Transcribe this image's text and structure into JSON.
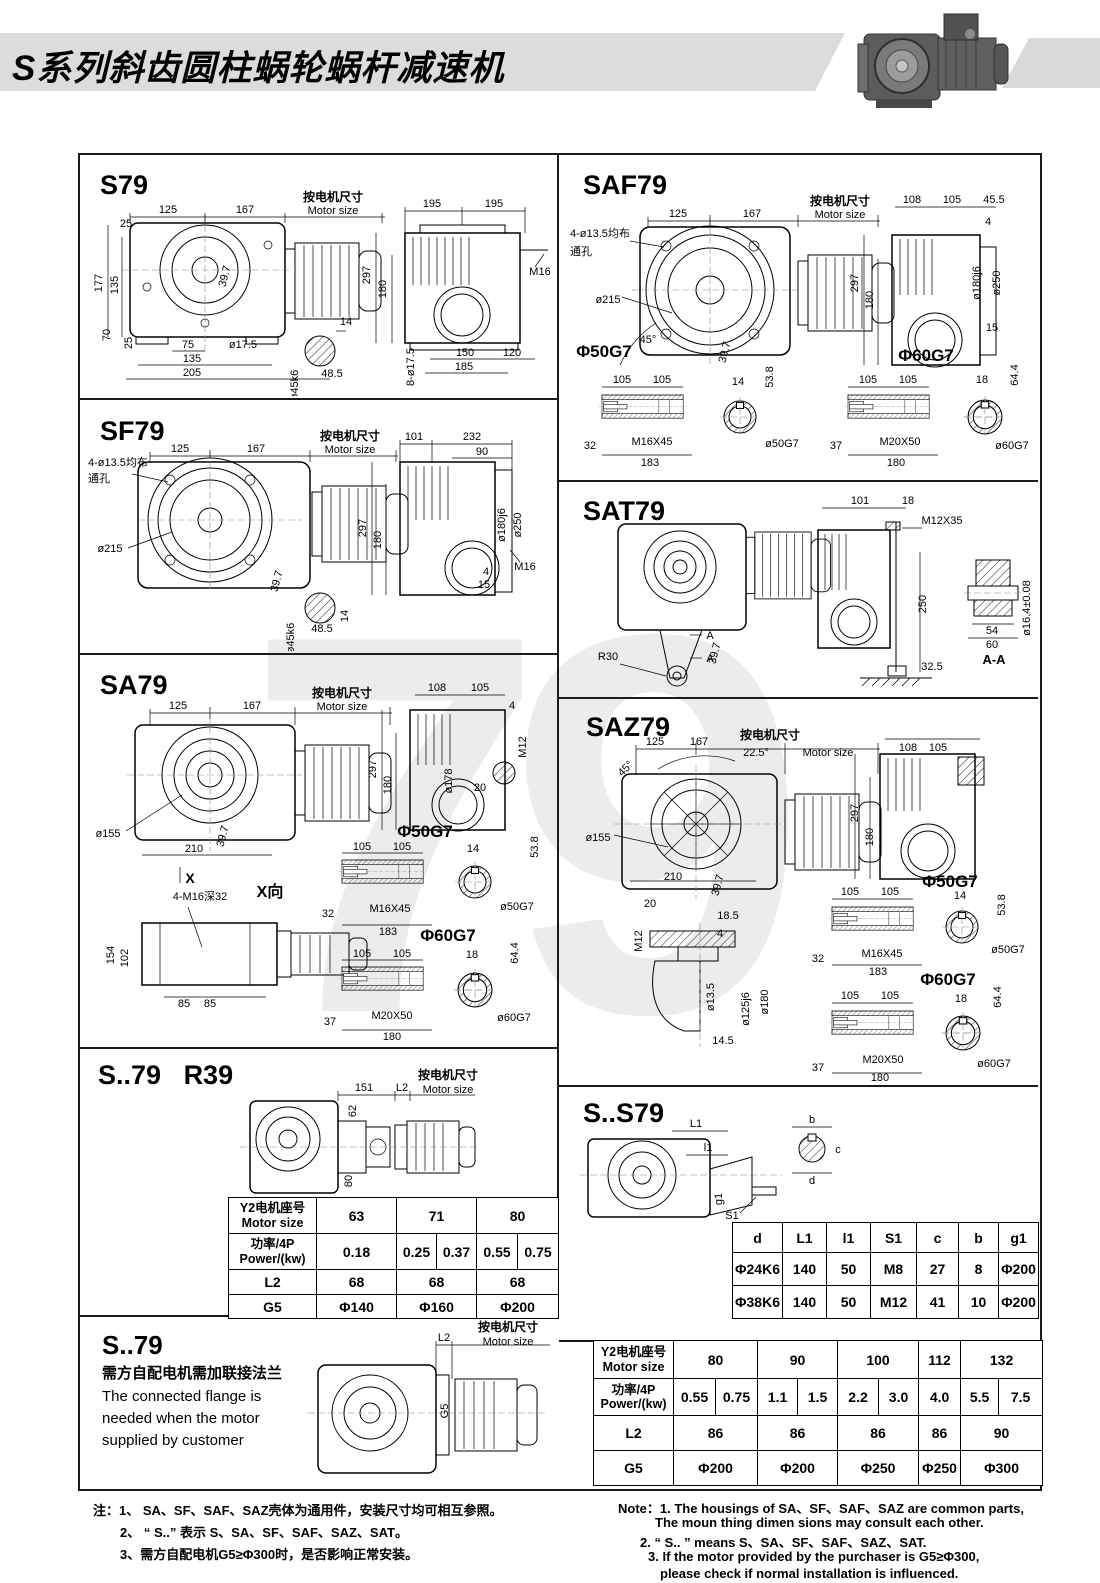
{
  "header": {
    "title": "S系列斜齿圆柱蜗轮蜗杆减速机"
  },
  "watermark": "79",
  "common": {
    "motor_zh": "按电机尺寸",
    "motor_en": "Motor size"
  },
  "panels": {
    "s79": {
      "title": "S79",
      "d125": "125",
      "d167": "167",
      "d25t": "25",
      "d177": "177",
      "d135l": "135",
      "d70": "70",
      "d25b": "25",
      "d75": "75",
      "dia175": "ø17.5",
      "d135b": "135",
      "d205": "205",
      "d397": "39.7",
      "d14": "14",
      "dia45k6": "ø45k6",
      "d485": "48.5",
      "d195a": "195",
      "d195b": "195",
      "d297": "297",
      "d180": "180",
      "m16": "M16",
      "d150": "150",
      "d120": "120",
      "d185": "185",
      "dia8175": "8-ø17.5"
    },
    "sf79": {
      "title": "SF79",
      "d125": "125",
      "d167": "167",
      "holes1": "4-ø13.5均布",
      "holes2": "通孔",
      "dia215": "ø215",
      "d397": "39.7",
      "dia45k6": "ø45k6",
      "d485": "48.5",
      "d14": "14",
      "d101": "101",
      "d232": "232",
      "d90": "90",
      "d297": "297",
      "d180": "180",
      "dia180j6": "ø180j6",
      "dia250": "ø250",
      "d4": "4",
      "d15": "15",
      "m16": "M16"
    },
    "sa79": {
      "title": "SA79",
      "d125": "125",
      "d167": "167",
      "dia155": "ø155",
      "d210": "210",
      "d397": "39.7",
      "x": "X",
      "xview": "X向",
      "tap": "4-M16深32",
      "d154": "154",
      "d102": "102",
      "d85a": "85",
      "d85b": "85",
      "d108": "108",
      "d105": "105",
      "d4": "4",
      "d297": "297",
      "d180": "180",
      "dia178": "ø178",
      "m12": "M12",
      "d20": "20",
      "phi50": "Φ50G7",
      "p50_105a": "105",
      "p50_105b": "105",
      "p50_14": "14",
      "p50_538": "53.8",
      "p50_32": "32",
      "p50_m16x45": "M16X45",
      "p50_183": "183",
      "p50_dia": "ø50G7",
      "phi60": "Φ60G7",
      "p60_105a": "105",
      "p60_105b": "105",
      "p60_18": "18",
      "p60_644": "64.4",
      "p60_37": "37",
      "p60_m20x50": "M20X50",
      "p60_180": "180",
      "p60_dia": "ø60G7"
    },
    "s79r39": {
      "title": "S..79",
      "title2": "R39",
      "d151": "151",
      "l2": "L2",
      "d62": "62",
      "d80": "80"
    },
    "s79b": {
      "title": "S..79",
      "zh": "需方自配电机需加联接法兰",
      "en1": "The connected flange is",
      "en2": "needed when  the motor",
      "en3": "supplied by customer",
      "l2": "L2",
      "g5": "G5"
    },
    "saf79": {
      "title": "SAF79",
      "d125": "125",
      "d167": "167",
      "holes1": "4-ø13.5均布",
      "holes2": "通孔",
      "dia215": "ø215",
      "deg45": "45°",
      "d397": "39.7",
      "d108": "108",
      "d105": "105",
      "d455": "45.5",
      "d4": "4",
      "d297": "297",
      "d180": "180",
      "dia180j6": "ø180j6",
      "dia250": "ø250",
      "d15": "15",
      "phi50": "Φ50G7",
      "p50_105a": "105",
      "p50_105b": "105",
      "p50_14": "14",
      "p50_538": "53.8",
      "p50_32": "32",
      "p50_m16x45": "M16X45",
      "p50_183": "183",
      "p50_dia": "ø50G7",
      "phi60": "Φ60G7",
      "p60_105a": "105",
      "p60_105b": "105",
      "p60_18": "18",
      "p60_644": "64.4",
      "p60_37": "37",
      "p60_m20x50": "M20X50",
      "p60_180": "180",
      "p60_dia": "ø60G7"
    },
    "sat79": {
      "title": "SAT79",
      "d101": "101",
      "d18": "18",
      "m12x35": "M12X35",
      "r30": "R30",
      "a1": "A",
      "a2": "A",
      "d397": "39.7",
      "d250": "250",
      "d325": "32.5",
      "d54": "54",
      "d60": "60",
      "dia164": "ø16.4±0.08",
      "aa": "A-A"
    },
    "saz79": {
      "title": "SAZ79",
      "d125": "125",
      "d167": "167",
      "deg225": "22.5°",
      "deg45": "45°",
      "dia155": "ø155",
      "d210": "210",
      "d397": "39.7",
      "d108": "108",
      "d105": "105",
      "d297": "297",
      "d180": "180",
      "d20": "20",
      "d185": "18.5",
      "d4": "4",
      "m12": "M12",
      "dia135": "ø13.5",
      "dia125j6": "ø125j6",
      "dia180": "ø180",
      "d145": "14.5",
      "phi50": "Φ50G7",
      "p50_105a": "105",
      "p50_105b": "105",
      "p50_14": "14",
      "p50_538": "53.8",
      "p50_32": "32",
      "p50_m16x45": "M16X45",
      "p50_183": "183",
      "p50_dia": "ø50G7",
      "phi60": "Φ60G7",
      "p60_105a": "105",
      "p60_105b": "105",
      "p60_18": "18",
      "p60_644": "64.4",
      "p60_37": "37",
      "p60_m20x50": "M20X50",
      "p60_180": "180",
      "p60_dia": "ø60G7"
    },
    "ss79": {
      "title": "S..S79",
      "l1": "L1",
      "l1s": "l1",
      "s1": "S1",
      "g1": "g1",
      "b": "b",
      "c": "c",
      "d": "d"
    }
  },
  "tables": {
    "t1": {
      "y2_zh": "Y2电机座号",
      "y2_en": "Motor size",
      "sizes": [
        "63",
        "71",
        "80"
      ],
      "pw_zh": "功率/4P",
      "pw_en": "Power/(kw)",
      "powers": [
        "0.18",
        "0.25",
        "0.37",
        "0.55",
        "0.75"
      ],
      "l2": "L2",
      "l2v": [
        "68",
        "68",
        "68"
      ],
      "g5": "G5",
      "g5v": [
        "Φ140",
        "Φ160",
        "Φ200"
      ]
    },
    "t2": {
      "h": [
        "d",
        "L1",
        "l1",
        "S1",
        "c",
        "b",
        "g1"
      ],
      "r1": [
        "Φ24K6",
        "140",
        "50",
        "M8",
        "27",
        "8",
        "Φ200"
      ],
      "r2": [
        "Φ38K6",
        "140",
        "50",
        "M12",
        "41",
        "10",
        "Φ200"
      ]
    },
    "t3": {
      "y2_zh": "Y2电机座号",
      "y2_en": "Motor size",
      "sizes": [
        "80",
        "90",
        "100",
        "112",
        "132"
      ],
      "pw_zh": "功率/4P",
      "pw_en": "Power/(kw)",
      "powers": [
        "0.55",
        "0.75",
        "1.1",
        "1.5",
        "2.2",
        "3.0",
        "4.0",
        "5.5",
        "7.5"
      ],
      "l2": "L2",
      "l2v": [
        "86",
        "86",
        "86",
        "86",
        "90"
      ],
      "g5": "G5",
      "g5v": [
        "Φ200",
        "Φ200",
        "Φ250",
        "Φ250",
        "Φ300"
      ]
    }
  },
  "notes": {
    "zh1": "注：1、 SA、SF、SAF、SAZ壳体为通用件，安装尺寸均可相互参照。",
    "zh2": "2、 “ S..” 表示 S、SA、SF、SAF、SAZ、SAT。",
    "zh3": "3、需方自配电机G5≥Φ300时，是否影响正常安装。",
    "en1": "Note：1.  The housings of SA、SF、SAF、SAZ are common parts,",
    "en2": "The moun thing dimen sions may consult each other.",
    "en3": "2. “ S.. ”  means  S、SA、SF、SAF、SAZ、SAT.",
    "en4": "3.  If the motor provided by the purchaser is G5≥Φ300,",
    "en5": "please check if normal installation is influenced."
  }
}
